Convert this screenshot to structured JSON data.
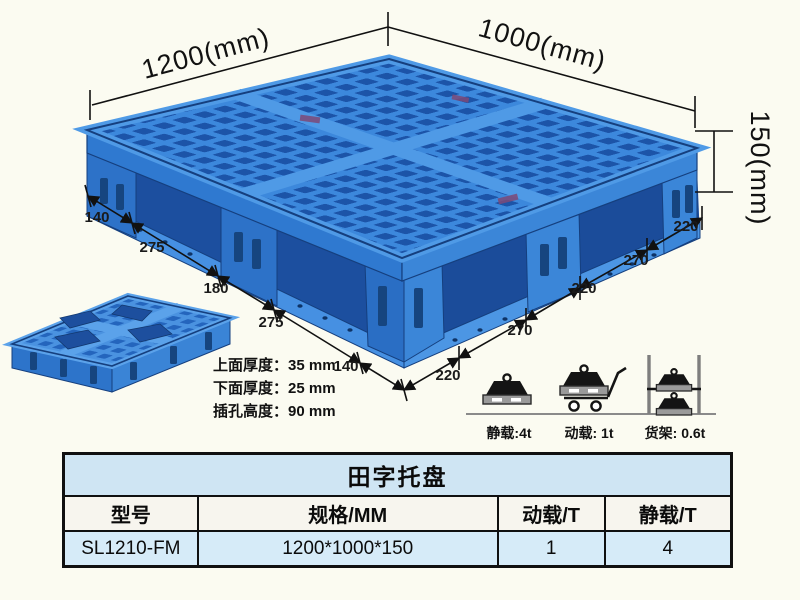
{
  "annotations": {
    "width_dim": "1200(mm)",
    "depth_dim": "1000(mm)",
    "height_dim": "150(mm)",
    "left_edge_dims": [
      "140",
      "275",
      "180",
      "275",
      "140"
    ],
    "right_edge_dims": [
      "220",
      "270",
      "220",
      "270",
      "220"
    ]
  },
  "thickness_specs": [
    {
      "label": "上面厚度：",
      "value": "35 mm"
    },
    {
      "label": "下面厚度：",
      "value": "25 mm"
    },
    {
      "label": "插孔高度：",
      "value": "90 mm"
    }
  ],
  "load_ratings": [
    {
      "icon": "static-load-icon",
      "label": "静载:4t"
    },
    {
      "icon": "dynamic-load-icon",
      "label": "动载: 1t"
    },
    {
      "icon": "rack-load-icon",
      "label": "货架: 0.6t"
    }
  ],
  "spec_table": {
    "title": "田字托盘",
    "headers": [
      "型号",
      "规格/MM",
      "动载/T",
      "静载/T"
    ],
    "row": [
      "SL1210-FM",
      "1200*1000*150",
      "1",
      "4"
    ]
  },
  "colors": {
    "pallet_blue": "#3c88dc",
    "pallet_hole_dark": "#1c54a8",
    "pallet_rim_light": "#4f9ae6",
    "outline_navy": "#153f7e",
    "table_title_bg": "#cfe5f3",
    "table_header_bg": "#f7f5ee",
    "table_row_bg": "#d6ebf8",
    "page_background": "#fbfbf1"
  }
}
